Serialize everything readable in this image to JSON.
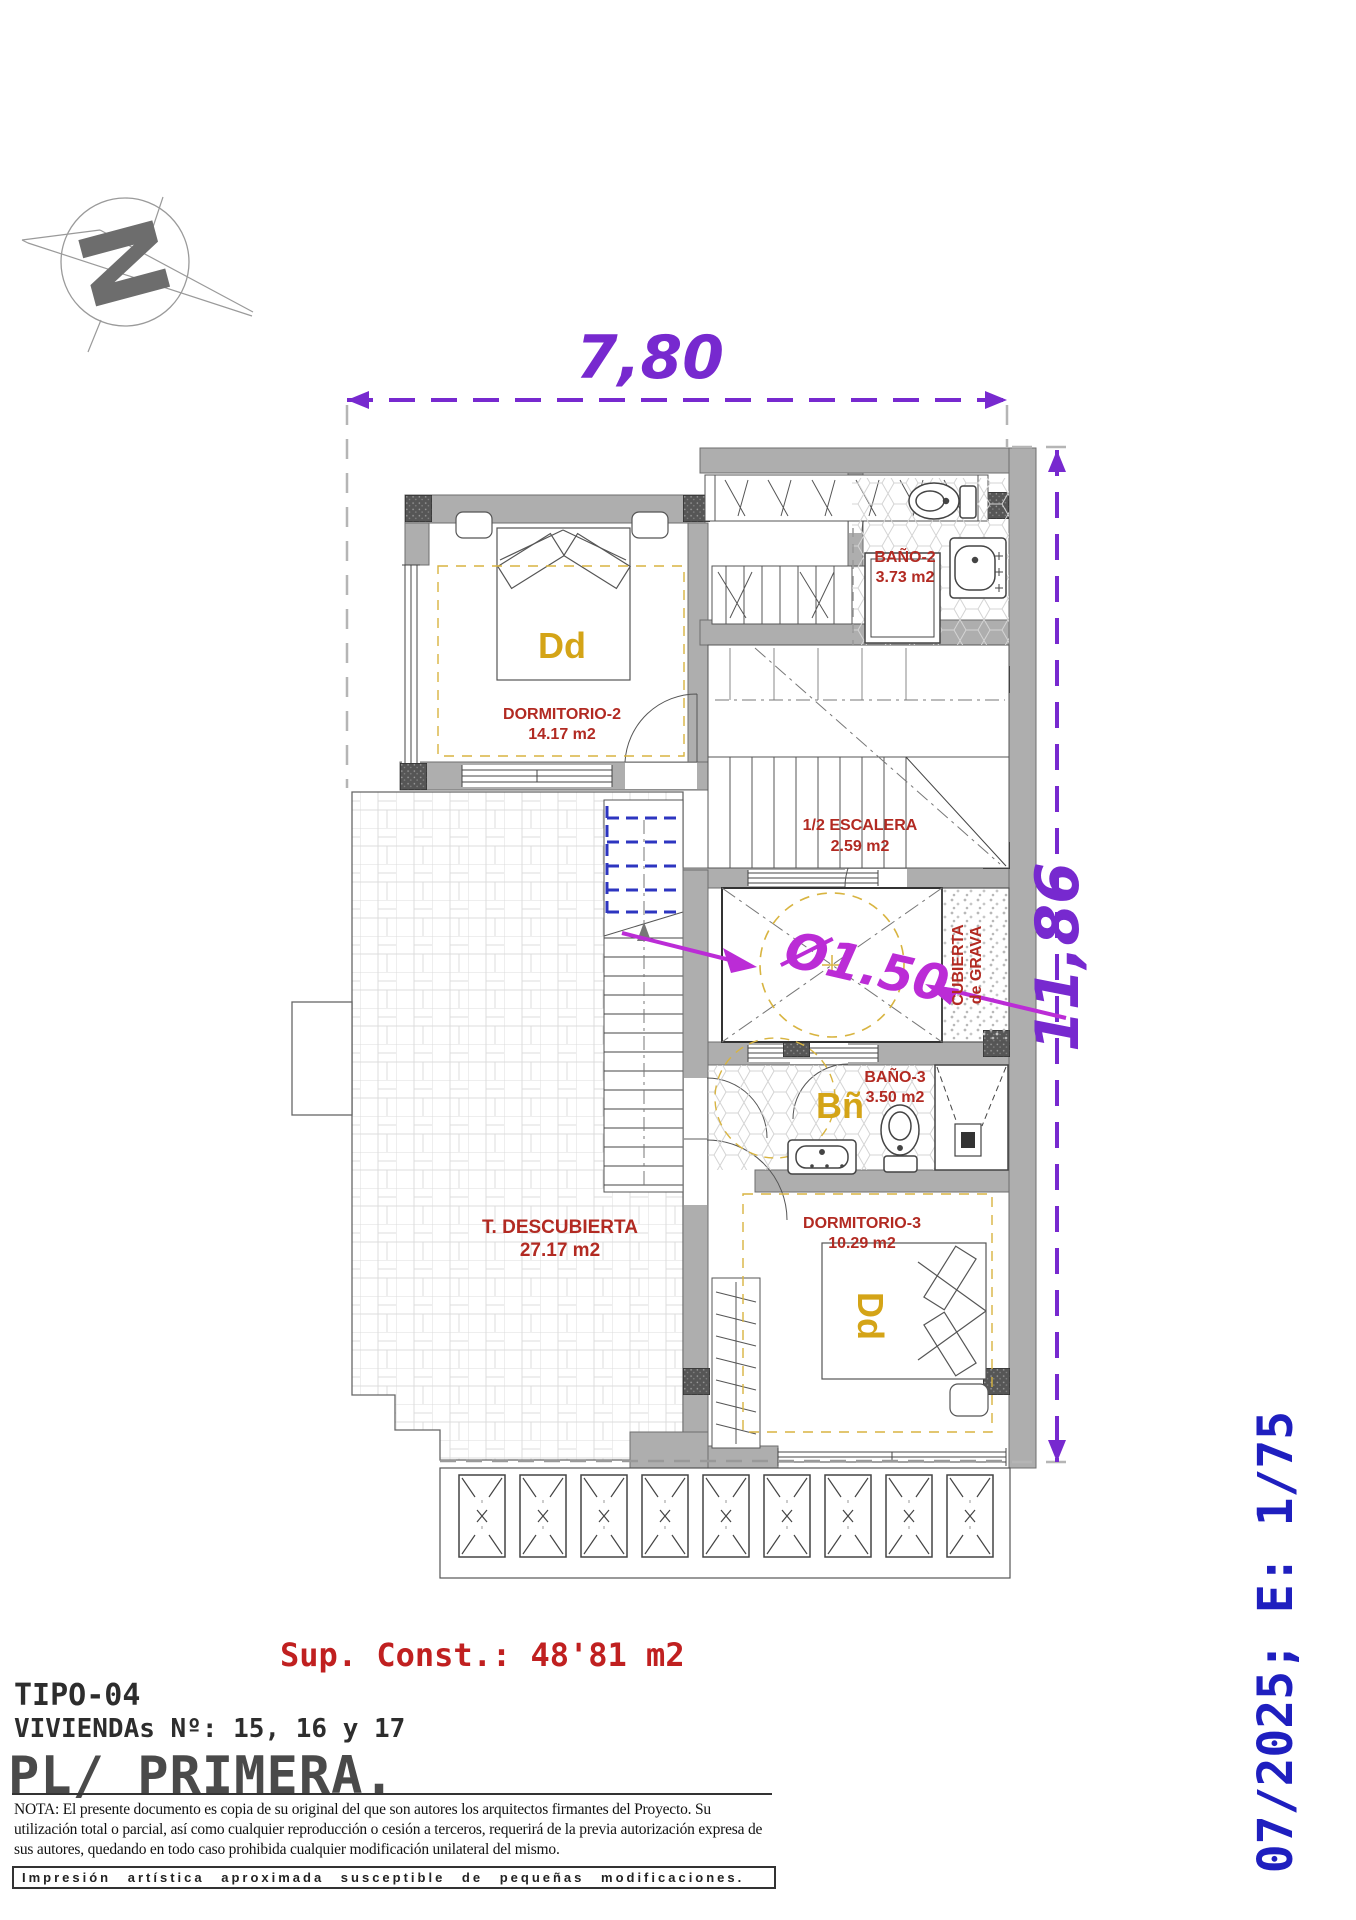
{
  "dimensions": {
    "width": "7,80",
    "height": "11,86",
    "lift_diameter": "Ø1.50"
  },
  "rooms": {
    "bano2": {
      "name": "BAÑO-2",
      "area": "3.73 m2"
    },
    "dormitorio2": {
      "name": "DORMITORIO-2",
      "area": "14.17 m2"
    },
    "escalera": {
      "name": "1/2 ESCALERA",
      "area": "2.59 m2"
    },
    "cubierta": {
      "line1": "CUBIERTA",
      "line2": "de GRAVA"
    },
    "bano3": {
      "name": "BAÑO-3",
      "area": "3.50 m2"
    },
    "dormitorio3": {
      "name": "DORMITORIO-3",
      "area": "10.29 m2"
    },
    "terraza": {
      "name": "T. DESCUBIERTA",
      "area": "27.17 m2"
    }
  },
  "furniture": {
    "bed2": "Dd",
    "bath3": "Bñ",
    "bed3": "Dd"
  },
  "compass": {
    "letter": "N"
  },
  "summary": {
    "sup_const": "Sup. Const.: 48'81 m2"
  },
  "title_block": {
    "tipo": "TIPO-04",
    "viviendas": "VIVIENDAs Nº: 15, 16 y 17",
    "planta": "PL/ PRIMERA."
  },
  "nota": "NOTA: El presente documento es copia de su original del que son autores los arquitectos firmantes del Proyecto. Su utilización total o parcial, así como cualquier reproducción o cesión a terceros, requerirá  de la previa autorización expresa de sus autores, quedando en todo caso prohibida cualquier modificación unilateral del mismo.",
  "footer": "Impresión artística aproximada susceptible de pequeñas modificaciones.",
  "stamp": "07/2025; E: 1/75",
  "colors": {
    "dimension_purple": "#7729cf",
    "diameter_magenta": "#bb2cd6",
    "label_red": "#b22a22",
    "furniture_gold": "#d4a417",
    "stamp_blue": "#1f1fbf",
    "wall_gray": "#aeaeae"
  }
}
